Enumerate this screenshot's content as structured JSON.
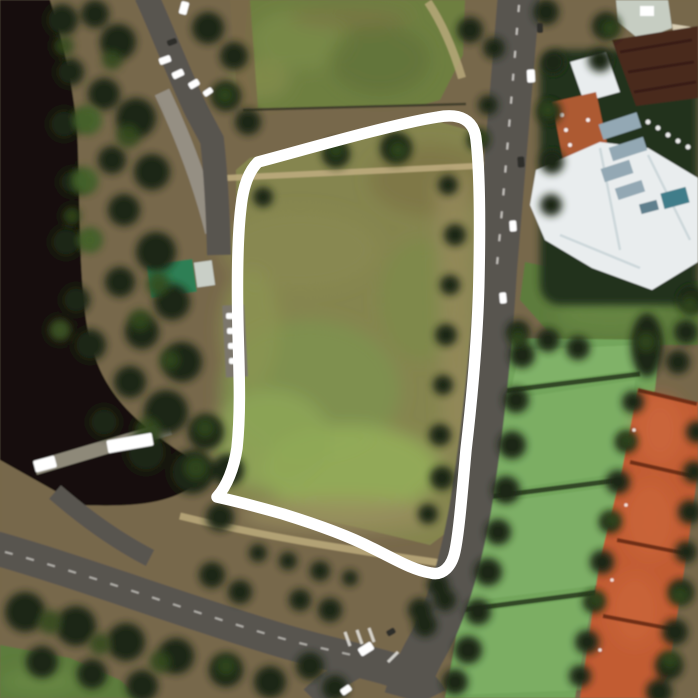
{
  "meta": {
    "description": "Aerial satellite photograph of a riverside park precinct: a mown grass field circled by a thick hand-drawn white loop, bounded by a tree-lined road on the right, a dark river and woodland on the left, a clubhouse building with white roof at top right, rows of grass and orange clay tennis courts at lower right, and a curving road with an intersection at the bottom.",
    "width": 698,
    "height": 698
  },
  "annotation": {
    "id": "hand-drawn-loop",
    "description": "thick freehand white loop circling the central grass field, rounded top corners, sharp beak corner at bottom-left, rounded u-turn at bottom-right",
    "color": "#ffffff",
    "stroke_width": 11.5,
    "path": "M 258,162 C 300,151 392,124 438,117 C 460,113 474,120 476,139 C 480,172 480,225 479,275 C 478,338 472,398 466,450 C 462,494 459,532 455,551 C 452,566 443,576 431,573 C 412,570 393,558 372,548 C 345,534 312,523 283,514 C 262,508 235,501 217,497 C 227,486 234,468 237,448 C 241,410 239,370 238,330 C 237,285 237,240 241,207 C 243,188 248,172 258,162 Z"
  },
  "features": [
    {
      "id": "river",
      "label": "dark river along left edge"
    },
    {
      "id": "left-woodland",
      "label": "dense tree cluster between river and field"
    },
    {
      "id": "annotated-field",
      "label": "olive-green park field inside the white loop"
    },
    {
      "id": "upper-field",
      "label": "green sports field at top"
    },
    {
      "id": "main-road",
      "label": "vertical road with traffic on right of loop"
    },
    {
      "id": "sweeping-road",
      "label": "curving road across bottom with intersection"
    },
    {
      "id": "clubhouse",
      "label": "white-roofed clubhouse complex with maroon and orange roofs, top right"
    },
    {
      "id": "green-roof-shed",
      "label": "small teal-green roofed building near river"
    },
    {
      "id": "grass-courts",
      "label": "band of green grass tennis courts, lower right"
    },
    {
      "id": "clay-courts",
      "label": "row of orange clay tennis courts, far right"
    },
    {
      "id": "parked-cars",
      "label": "white parked cars near woodland and roads"
    },
    {
      "id": "bus",
      "label": "white bus/boat shape on riverside path"
    }
  ],
  "colors": {
    "ground": "#77684b",
    "river": "#16110b",
    "bankPath": "#95907f",
    "treeDark": "#1c2612",
    "treeMid": "#324a1e",
    "hedgeGreen": "#4a6b2e",
    "topField": "#6e7f41",
    "fieldOlive": "#85854f",
    "fieldGreen": "#7e9150",
    "fieldBright": "#93ad5a",
    "fieldBrown": "#7d7443",
    "dirtStrip": "#96895c",
    "pathTan": "#bcab7d",
    "pathGrey": "#98948a",
    "road": "#585550",
    "marking": "#e8e6e0",
    "lawn": "#5d7b3c",
    "lawnLight": "#6c8b46",
    "grassCourt": "#73a65c",
    "grassCourtLight": "#84b56c",
    "grassDivider": "#2a3d20",
    "clayCourt": "#c25c33",
    "clayCourtLight": "#d06c3e",
    "clayDivider": "#6b2d17",
    "roofMaroon": "#48291f",
    "roofRidge": "#331c14",
    "roofOrange": "#ad5a33",
    "roofWhite": "#e9edee",
    "roofShade": "#c6d2d6",
    "machinery": "#93a8b4",
    "poolTeal": "#3f7d8a",
    "buildingLight": "#c6cdc2",
    "cream": "#d8cdb2",
    "greenRoof": "#2f7f55",
    "shedWhite": "#c9cfc7",
    "fence": "#3f3d2a",
    "white": "#ffffff",
    "carDark": "#2e2e2c",
    "buildingBackdrop": "#22301a"
  },
  "scene": {
    "trees_dark": [
      [
        62,
        20,
        16
      ],
      [
        70,
        72,
        14
      ],
      [
        64,
        124,
        15
      ],
      [
        72,
        182,
        13
      ],
      [
        66,
        242,
        15
      ],
      [
        76,
        300,
        14
      ],
      [
        90,
        345,
        16
      ],
      [
        118,
        42,
        18
      ],
      [
        104,
        94,
        16
      ],
      [
        136,
        118,
        20
      ],
      [
        112,
        160,
        14
      ],
      [
        152,
        172,
        18
      ],
      [
        124,
        210,
        16
      ],
      [
        156,
        252,
        20
      ],
      [
        120,
        282,
        15
      ],
      [
        172,
        302,
        18
      ],
      [
        142,
        332,
        17
      ],
      [
        182,
        362,
        20
      ],
      [
        130,
        382,
        16
      ],
      [
        166,
        412,
        22
      ],
      [
        206,
        432,
        18
      ],
      [
        146,
        452,
        20
      ],
      [
        192,
        472,
        22
      ],
      [
        228,
        470,
        16
      ],
      [
        104,
        422,
        15
      ],
      [
        95,
        14,
        14
      ],
      [
        208,
        28,
        16
      ],
      [
        234,
        56,
        14
      ],
      [
        226,
        96,
        15
      ],
      [
        248,
        122,
        13
      ],
      [
        220,
        517,
        14
      ],
      [
        336,
        154,
        14
      ],
      [
        396,
        148,
        16
      ],
      [
        263,
        197,
        10
      ],
      [
        448,
        185,
        10
      ],
      [
        455,
        235,
        11
      ],
      [
        450,
        285,
        10
      ],
      [
        446,
        335,
        11
      ],
      [
        443,
        385,
        10
      ],
      [
        440,
        435,
        11
      ],
      [
        442,
        478,
        12
      ],
      [
        428,
        514,
        10
      ],
      [
        478,
        140,
        11
      ],
      [
        488,
        105,
        10
      ],
      [
        470,
        30,
        13
      ],
      [
        494,
        48,
        11
      ],
      [
        546,
        12,
        13
      ],
      [
        553,
        62,
        12
      ],
      [
        549,
        112,
        12
      ],
      [
        552,
        162,
        12
      ],
      [
        551,
        205,
        11
      ],
      [
        522,
        355,
        13
      ],
      [
        516,
        400,
        13
      ],
      [
        512,
        445,
        14
      ],
      [
        506,
        490,
        14
      ],
      [
        498,
        532,
        13
      ],
      [
        488,
        572,
        14
      ],
      [
        478,
        612,
        13
      ],
      [
        468,
        650,
        14
      ],
      [
        455,
        682,
        13
      ],
      [
        518,
        332,
        12
      ],
      [
        548,
        340,
        12
      ],
      [
        578,
        348,
        12
      ],
      [
        606,
        26,
        14
      ],
      [
        600,
        60,
        12
      ],
      [
        692,
        300,
        14
      ],
      [
        686,
        332,
        12
      ],
      [
        678,
        362,
        12
      ],
      [
        633,
        402,
        11
      ],
      [
        626,
        442,
        11
      ],
      [
        618,
        482,
        12
      ],
      [
        610,
        522,
        11
      ],
      [
        602,
        562,
        12
      ],
      [
        594,
        602,
        11
      ],
      [
        587,
        642,
        12
      ],
      [
        580,
        676,
        11
      ],
      [
        697,
        432,
        11
      ],
      [
        694,
        472,
        11
      ],
      [
        690,
        512,
        12
      ],
      [
        686,
        552,
        11
      ],
      [
        681,
        592,
        13
      ],
      [
        675,
        632,
        13
      ],
      [
        669,
        666,
        14
      ],
      [
        659,
        692,
        13
      ],
      [
        25,
        612,
        20
      ],
      [
        76,
        626,
        20
      ],
      [
        126,
        642,
        19
      ],
      [
        176,
        656,
        18
      ],
      [
        226,
        670,
        17
      ],
      [
        270,
        682,
        16
      ],
      [
        42,
        662,
        16
      ],
      [
        92,
        674,
        15
      ],
      [
        142,
        686,
        16
      ],
      [
        310,
        666,
        14
      ],
      [
        212,
        575,
        13
      ],
      [
        240,
        592,
        12
      ],
      [
        258,
        553,
        9
      ],
      [
        288,
        561,
        9
      ],
      [
        320,
        571,
        10
      ],
      [
        350,
        578,
        8
      ],
      [
        330,
        610,
        12
      ],
      [
        300,
        600,
        11
      ],
      [
        420,
        610,
        12
      ],
      [
        438,
        585,
        11
      ],
      [
        335,
        688,
        13
      ],
      [
        425,
        625,
        12
      ],
      [
        445,
        600,
        11
      ]
    ],
    "trees_light": [
      [
        64,
        46,
        10
      ],
      [
        72,
        216,
        9
      ],
      [
        128,
        136,
        12
      ],
      [
        158,
        284,
        12
      ],
      [
        148,
        430,
        13
      ],
      [
        196,
        468,
        12
      ],
      [
        336,
        150,
        8
      ],
      [
        398,
        150,
        9
      ],
      [
        518,
        338,
        8
      ],
      [
        50,
        622,
        12
      ],
      [
        100,
        644,
        11
      ],
      [
        160,
        662,
        11
      ],
      [
        226,
        666,
        10
      ],
      [
        86,
        120,
        13
      ],
      [
        84,
        182,
        12
      ],
      [
        90,
        240,
        11
      ],
      [
        646,
        342,
        10
      ],
      [
        112,
        60,
        10
      ],
      [
        140,
        320,
        11
      ],
      [
        170,
        360,
        10
      ],
      [
        205,
        428,
        10
      ],
      [
        225,
        95,
        9
      ],
      [
        480,
        138,
        8
      ],
      [
        548,
        110,
        9
      ],
      [
        610,
        28,
        9
      ],
      [
        690,
        305,
        9
      ],
      [
        627,
        440,
        8
      ],
      [
        612,
        520,
        8
      ],
      [
        596,
        600,
        8
      ],
      [
        680,
        595,
        9
      ],
      [
        670,
        660,
        9
      ]
    ],
    "vehicles": [
      [
        184,
        8,
        8,
        13,
        15,
        "w"
      ],
      [
        165,
        60,
        12,
        7,
        -20,
        "w"
      ],
      [
        178,
        74,
        12,
        7,
        -25,
        "w"
      ],
      [
        194,
        84,
        11,
        7,
        -30,
        "w"
      ],
      [
        208,
        92,
        10,
        6,
        -35,
        "w"
      ],
      [
        172,
        42,
        10,
        6,
        -20,
        "d"
      ],
      [
        231,
        316,
        10,
        6,
        0,
        "w"
      ],
      [
        232,
        331,
        10,
        6,
        0,
        "w"
      ],
      [
        233,
        346,
        10,
        6,
        0,
        "w"
      ],
      [
        234,
        361,
        10,
        6,
        0,
        "w"
      ],
      [
        531,
        76,
        8,
        13,
        -3,
        "w"
      ],
      [
        521,
        162,
        7,
        11,
        -4,
        "d"
      ],
      [
        513,
        226,
        7,
        11,
        -4,
        "w"
      ],
      [
        540,
        28,
        6,
        10,
        -2,
        "d"
      ],
      [
        503,
        298,
        7,
        11,
        -5,
        "w"
      ],
      [
        366,
        649,
        15,
        9,
        -32,
        "w"
      ],
      [
        346,
        690,
        11,
        7,
        -35,
        "w"
      ],
      [
        391,
        632,
        9,
        6,
        -30,
        "d"
      ],
      [
        130,
        443,
        46,
        13,
        -10,
        "w"
      ],
      [
        45,
        464,
        22,
        12,
        -15,
        "w"
      ]
    ],
    "white_dots": [
      [
        648,
        122
      ],
      [
        658,
        128
      ],
      [
        668,
        135
      ],
      [
        678,
        141
      ],
      [
        688,
        147
      ]
    ],
    "net_posts": [
      [
        634,
        430
      ],
      [
        626,
        505
      ],
      [
        612,
        580
      ],
      [
        600,
        650
      ]
    ]
  }
}
